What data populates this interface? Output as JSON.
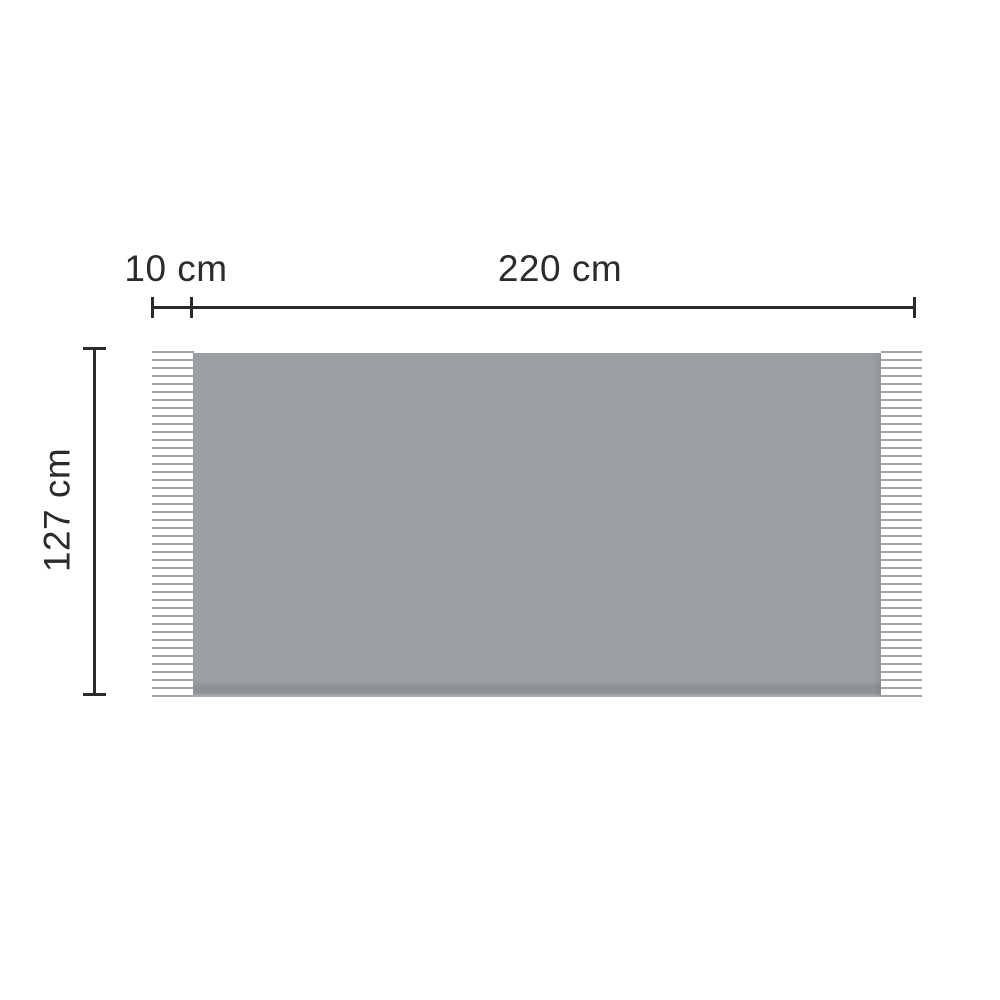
{
  "diagram": {
    "type": "product-dimension-diagram",
    "subject": "blanket-with-fringe",
    "labels": {
      "fringe_width": "10 cm",
      "body_width": "220 cm",
      "height": "127 cm"
    },
    "dimensions": {
      "fringe_width_cm": 10,
      "body_width_cm": 220,
      "height_cm": 127
    },
    "colors": {
      "background": "#ffffff",
      "blanket": "#9b9fa1",
      "blanket_shadow": "#8e9295",
      "fringe": "#a4a6a6",
      "dimension_line": "#2b2b2b"
    }
  }
}
